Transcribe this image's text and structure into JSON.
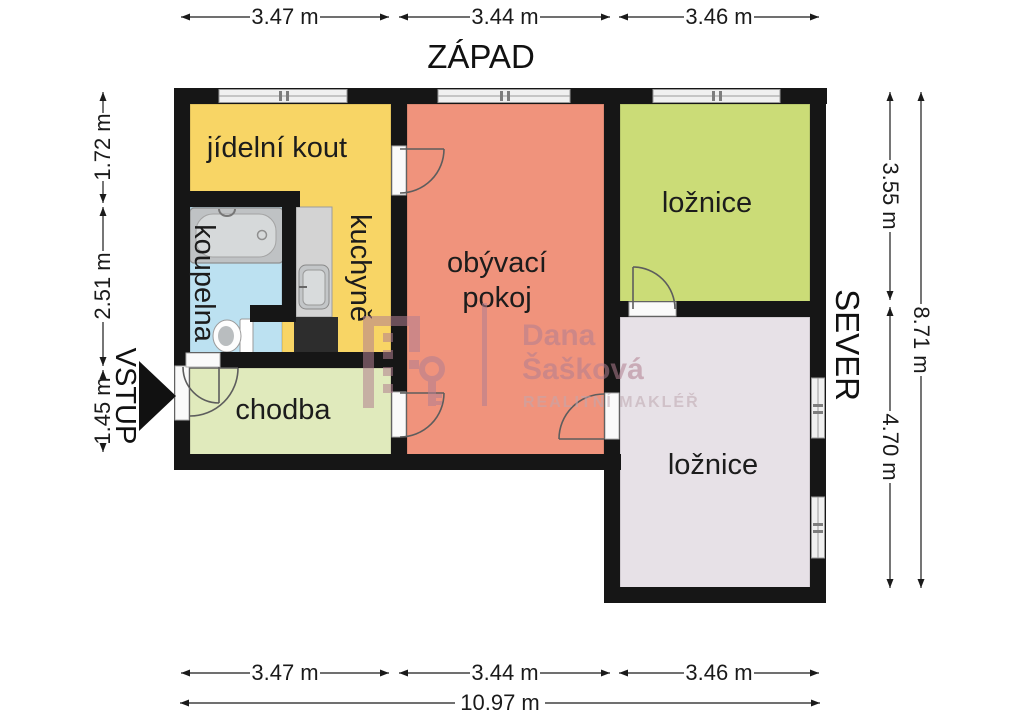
{
  "compass": {
    "west": "ZÁPAD",
    "north": "SEVER"
  },
  "entrance": {
    "label": "VSTUP"
  },
  "rooms": {
    "dining": "jídelní kout",
    "kitchen": "kuchyně",
    "bathroom": "koupelna",
    "living_line1": "obývací",
    "living_line2": "pokoj",
    "bedroom_north": "ložnice",
    "bedroom_east": "ložnice",
    "hallway": "chodba"
  },
  "dims": {
    "top": [
      "3.47 m",
      "3.44 m",
      "3.46 m"
    ],
    "bottom": [
      "3.47 m",
      "3.44 m",
      "3.46 m"
    ],
    "bottom_total": "10.97 m",
    "left": [
      "1.72 m",
      "2.51 m",
      "1.45 m"
    ],
    "right": [
      "3.55 m",
      "4.70 m"
    ],
    "right_total": "8.71 m"
  },
  "watermark": {
    "name_line1": "Dana",
    "name_line2": "Šašková",
    "subtitle": "REALITNÍ MAKLÉŘ"
  },
  "colors": {
    "dining_kitchen": "#f8d565",
    "living": "#f0937c",
    "bedroom_north": "#cbdc77",
    "bedroom_east": "#e7e1e7",
    "hallway": "#e0eabc",
    "bathroom": "#bce1f1",
    "wall": "#161616",
    "watermark": "#b27f90",
    "watermark_subtitle": "#bfa8b0"
  }
}
